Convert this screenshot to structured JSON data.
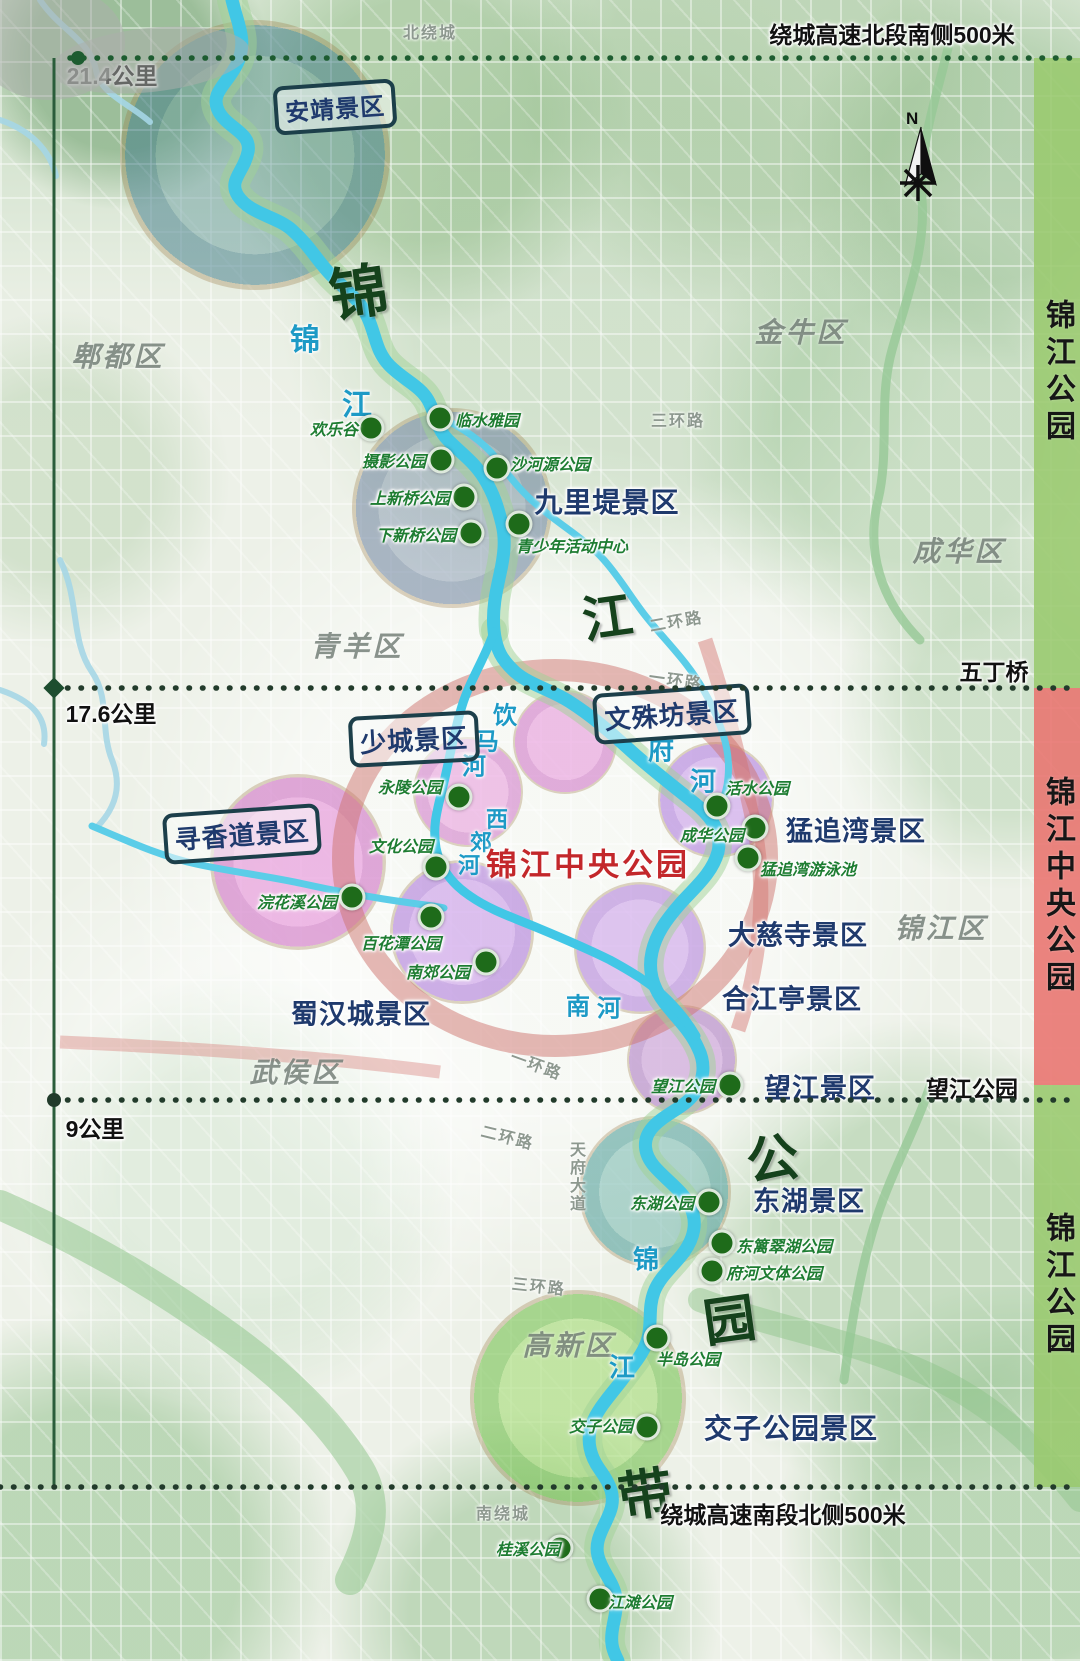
{
  "title": "锦江公园分区示意图",
  "colors": {
    "bar_green": "#9ac96e",
    "bar_red": "#e9736e",
    "park_green": "#1e7d32",
    "area_navy": "#1f3a6d",
    "center_red": "#c3272b",
    "river_blue": "#3fc4e4"
  },
  "rulers": {
    "top_banner": "绕城高速北段南侧500米",
    "bottom_banner": "绕城高速南段北侧500米",
    "km_21": "21.4公里",
    "km_17": "17.6公里",
    "km_9": "9公里",
    "wudingqiao": "五丁桥",
    "wangjiang_right": "望江公园"
  },
  "bars": [
    {
      "label": "锦江公园"
    },
    {
      "label": "锦江中央公园"
    },
    {
      "label": "锦江公园"
    }
  ],
  "center": {
    "title": "锦江中央公园"
  },
  "compass": {
    "n": "N"
  },
  "scenic_boxed": [
    {
      "name": "安靖景区",
      "x": 335,
      "y": 107,
      "size": 24,
      "rot": "-4deg"
    },
    {
      "name": "文殊坊景区",
      "x": 672,
      "y": 714,
      "size": 26,
      "rot": "-4deg"
    },
    {
      "name": "少城景区",
      "x": 414,
      "y": 739,
      "size": 26,
      "rot": "-3deg"
    },
    {
      "name": "寻香道景区",
      "x": 242,
      "y": 834,
      "size": 26,
      "rot": "-4deg"
    }
  ],
  "scenic_plain": [
    {
      "name": "九里堤景区",
      "x": 607,
      "y": 501,
      "size": 28
    },
    {
      "name": "猛追湾景区",
      "x": 856,
      "y": 829,
      "size": 27
    },
    {
      "name": "大慈寺景区",
      "x": 798,
      "y": 933,
      "size": 27
    },
    {
      "name": "合江亭景区",
      "x": 792,
      "y": 997,
      "size": 27
    },
    {
      "name": "望江景区",
      "x": 820,
      "y": 1086,
      "size": 27
    },
    {
      "name": "东湖景区",
      "x": 809,
      "y": 1199,
      "size": 27
    },
    {
      "name": "交子公园景区",
      "x": 791,
      "y": 1427,
      "size": 28
    },
    {
      "name": "蜀汉城景区",
      "x": 361,
      "y": 1012,
      "size": 27
    }
  ],
  "parks": [
    {
      "name": "欢乐谷",
      "lx": 334,
      "ly": 428,
      "dx": 371,
      "dy": 428
    },
    {
      "name": "临水雅园",
      "lx": 487,
      "ly": 419,
      "dx": 440,
      "dy": 418
    },
    {
      "name": "摄影公园",
      "lx": 394,
      "ly": 460,
      "dx": 441,
      "dy": 460
    },
    {
      "name": "沙河源公园",
      "lx": 550,
      "ly": 463,
      "dx": 497,
      "dy": 468
    },
    {
      "name": "上新桥公园",
      "lx": 410,
      "ly": 497,
      "dx": 464,
      "dy": 497
    },
    {
      "name": "下新桥公园",
      "lx": 416,
      "ly": 534,
      "dx": 471,
      "dy": 533
    },
    {
      "name": "青少年活动中心",
      "lx": 572,
      "ly": 545,
      "dx": 519,
      "dy": 524
    },
    {
      "name": "永陵公园",
      "lx": 410,
      "ly": 786,
      "dx": 459,
      "dy": 797
    },
    {
      "name": "活水公园",
      "lx": 757,
      "ly": 787,
      "dx": 717,
      "dy": 806
    },
    {
      "name": "成华公园",
      "lx": 712,
      "ly": 834,
      "dx": 755,
      "dy": 828
    },
    {
      "name": "猛追湾游泳池",
      "lx": 808,
      "ly": 868,
      "dx": 748,
      "dy": 858
    },
    {
      "name": "文化公园",
      "lx": 401,
      "ly": 845,
      "dx": 436,
      "dy": 867
    },
    {
      "name": "浣花溪公园",
      "lx": 297,
      "ly": 901,
      "dx": 352,
      "dy": 897
    },
    {
      "name": "百花潭公园",
      "lx": 401,
      "ly": 942,
      "dx": 431,
      "dy": 917
    },
    {
      "name": "南郊公园",
      "lx": 438,
      "ly": 971,
      "dx": 486,
      "dy": 962
    },
    {
      "name": "望江公园",
      "lx": 683,
      "ly": 1085,
      "dx": 730,
      "dy": 1085
    },
    {
      "name": "东湖公园",
      "lx": 662,
      "ly": 1202,
      "dx": 709,
      "dy": 1202
    },
    {
      "name": "东篱翠湖公园",
      "lx": 784,
      "ly": 1245,
      "dx": 722,
      "dy": 1243
    },
    {
      "name": "府河文体公园",
      "lx": 774,
      "ly": 1272,
      "dx": 712,
      "dy": 1271
    },
    {
      "name": "半岛公园",
      "lx": 688,
      "ly": 1358,
      "dx": 657,
      "dy": 1338
    },
    {
      "name": "交子公园",
      "lx": 601,
      "ly": 1425,
      "dx": 647,
      "dy": 1427
    },
    {
      "name": "桂溪公园",
      "lx": 528,
      "ly": 1548,
      "dx": 560,
      "dy": 1548
    },
    {
      "name": "江滩公园",
      "lx": 640,
      "ly": 1601,
      "dx": 600,
      "dy": 1599
    }
  ],
  "districts": [
    {
      "name": "郫都区",
      "x": 118,
      "y": 355
    },
    {
      "name": "金牛区",
      "x": 801,
      "y": 331
    },
    {
      "name": "成华区",
      "x": 959,
      "y": 550
    },
    {
      "name": "青羊区",
      "x": 357,
      "y": 645
    },
    {
      "name": "武侯区",
      "x": 296,
      "y": 1071
    },
    {
      "name": "锦江区",
      "x": 941,
      "y": 927
    },
    {
      "name": "高新区",
      "x": 569,
      "y": 1344
    }
  ],
  "roads": [
    {
      "name": "北绕城",
      "x": 430,
      "y": 31
    },
    {
      "name": "三环路",
      "x": 678,
      "y": 419
    },
    {
      "name": "二环路",
      "x": 676,
      "y": 620,
      "rot": "-10deg"
    },
    {
      "name": "一环路",
      "x": 676,
      "y": 679,
      "rot": "8deg"
    },
    {
      "name": "一环路",
      "x": 537,
      "y": 1064,
      "rot": "20deg"
    },
    {
      "name": "二环路",
      "x": 508,
      "y": 1136,
      "rot": "14deg"
    },
    {
      "name": "天府大道",
      "x": 575,
      "y": 1177,
      "wm": "vertical-rl"
    },
    {
      "name": "三环路",
      "x": 539,
      "y": 1285,
      "rot": "6deg"
    },
    {
      "name": "南绕城",
      "x": 503,
      "y": 1512
    }
  ],
  "river_labels": [
    {
      "ch": "锦",
      "x": 305,
      "y": 337,
      "size": 30
    },
    {
      "ch": "江",
      "x": 357,
      "y": 402,
      "size": 30
    },
    {
      "ch": "饮",
      "x": 505,
      "y": 713,
      "size": 24
    },
    {
      "ch": "马",
      "x": 487,
      "y": 739,
      "size": 24
    },
    {
      "ch": "河",
      "x": 474,
      "y": 764,
      "size": 24
    },
    {
      "ch": "府",
      "x": 661,
      "y": 749,
      "size": 26
    },
    {
      "ch": "河",
      "x": 703,
      "y": 780,
      "size": 26
    },
    {
      "ch": "西",
      "x": 497,
      "y": 818,
      "size": 22
    },
    {
      "ch": "郊",
      "x": 481,
      "y": 841,
      "size": 22
    },
    {
      "ch": "河",
      "x": 469,
      "y": 864,
      "size": 22
    },
    {
      "ch": "南",
      "x": 578,
      "y": 1004,
      "size": 24
    },
    {
      "ch": "河",
      "x": 609,
      "y": 1006,
      "size": 24
    },
    {
      "ch": "锦",
      "x": 646,
      "y": 1258,
      "size": 26
    },
    {
      "ch": "江",
      "x": 622,
      "y": 1366,
      "size": 26
    }
  ],
  "calligraphy": [
    {
      "ch": "锦",
      "x": 358,
      "y": 288,
      "size": 58
    },
    {
      "ch": "江",
      "x": 607,
      "y": 614,
      "size": 50
    },
    {
      "ch": "公",
      "x": 772,
      "y": 1155,
      "size": 52
    },
    {
      "ch": "园",
      "x": 729,
      "y": 1316,
      "size": 52
    },
    {
      "ch": "带",
      "x": 645,
      "y": 1490,
      "size": 54
    }
  ]
}
